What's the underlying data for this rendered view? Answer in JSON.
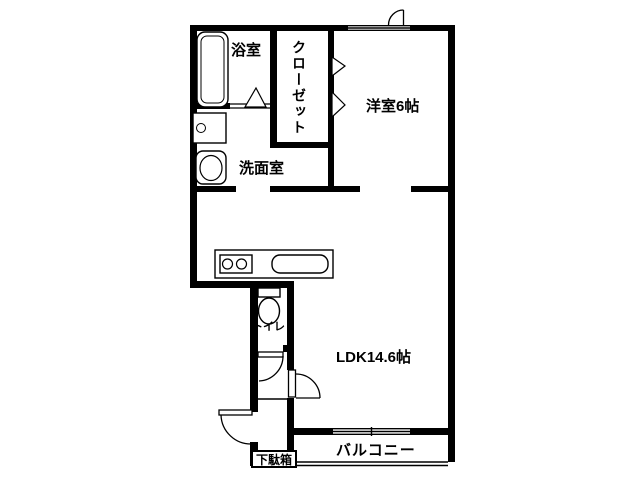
{
  "plan": {
    "title": "apartment-floor-plan",
    "rooms": {
      "bathroom": "浴室",
      "closet": "クローゼット",
      "western_room": "洋室6帖",
      "washroom": "洗面室",
      "toilet": "トイレ",
      "ldk": "LDK14.6帖",
      "balcony": "バルコニー",
      "shoe_cabinet": "下駄箱"
    },
    "colors": {
      "wall": "#000000",
      "background": "#ffffff",
      "line": "#000000"
    }
  }
}
